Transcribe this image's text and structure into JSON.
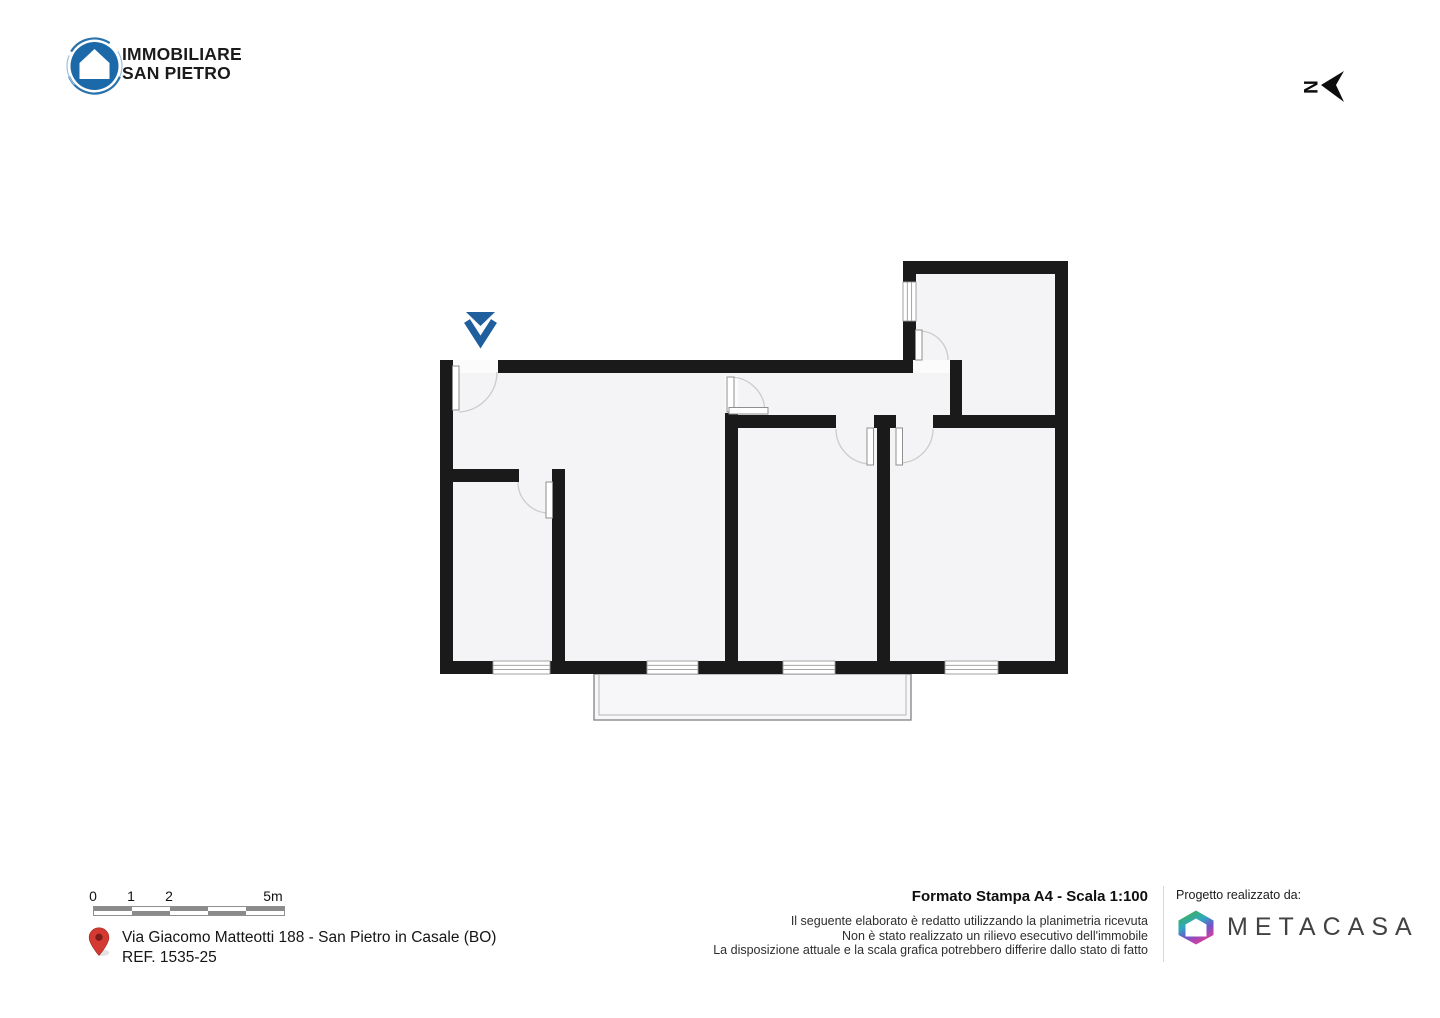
{
  "header": {
    "logo": {
      "line1": "IMMOBILIARE",
      "line2": "SAN PIETRO",
      "circle_color": "#1b69a9"
    },
    "north": {
      "letter": "N"
    }
  },
  "plan": {
    "marker_color": "#1f5f9e",
    "wall_color": "#1a1a1a",
    "floor_color": "#f4f4f6"
  },
  "footer": {
    "scale": {
      "labels": [
        "0",
        "1",
        "2",
        "5m"
      ]
    },
    "address": {
      "line1": "Via Giacomo Matteotti 188 - San Pietro in Casale (BO)",
      "line2": "REF. 1535-25",
      "pin_color": "#d43a31"
    },
    "print": {
      "title": "Formato Stampa A4 - Scala 1:100",
      "disclaimer": [
        "Il seguente elaborato è redatto utilizzando la planimetria ricevuta",
        "Non è stato realizzato un rilievo esecutivo dell'immobile",
        "La disposizione attuale e la scala grafica potrebbero differire dallo stato di fatto"
      ]
    },
    "credits": {
      "label": "Progetto realizzato da:",
      "brand": "METACASA"
    }
  }
}
